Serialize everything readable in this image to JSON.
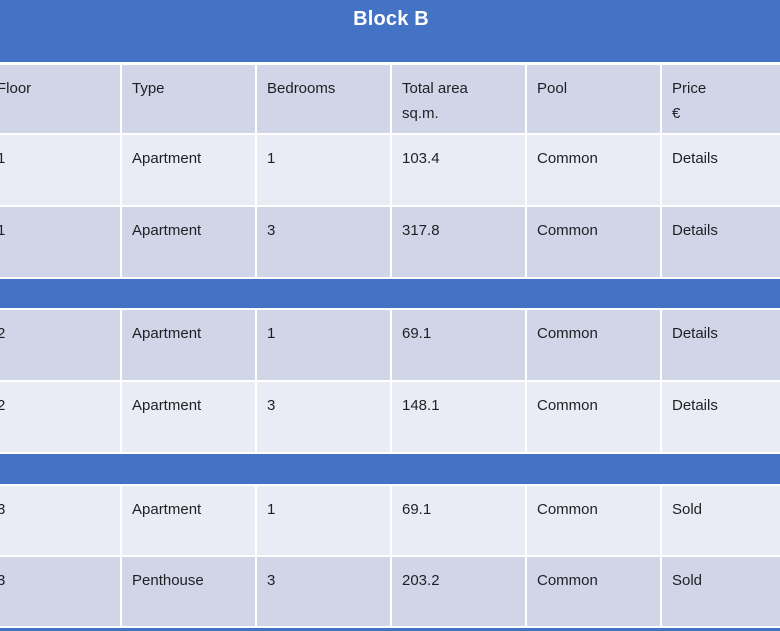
{
  "title": "Block B",
  "colors": {
    "header_blue": "#4472C4",
    "band_light": "#EAECF5",
    "band_dark": "#D0D5E8",
    "divider_white": "#FFFFFF",
    "text_dark": "#1F1F23",
    "title_white": "#FFFFFF"
  },
  "table": {
    "columns": [
      {
        "id": "floor",
        "label": "Floor"
      },
      {
        "id": "type",
        "label": "Type"
      },
      {
        "id": "bedrooms",
        "label": "Bedrooms"
      },
      {
        "id": "area",
        "label": "Total area",
        "sublabel": "sq.m."
      },
      {
        "id": "pool",
        "label": "Pool"
      },
      {
        "id": "price",
        "label": "Price",
        "sublabel": "€"
      }
    ],
    "groups": [
      {
        "floor": "1",
        "rows": [
          {
            "floor": "1",
            "type": "Apartment",
            "bedrooms": "1",
            "area": "103.4",
            "pool": "Common",
            "price": "Details"
          },
          {
            "floor": "1",
            "type": "Apartment",
            "bedrooms": "3",
            "area": "317.8",
            "pool": "Common",
            "price": "Details"
          }
        ]
      },
      {
        "floor": "2",
        "rows": [
          {
            "floor": "2",
            "type": "Apartment",
            "bedrooms": "1",
            "area": "69.1",
            "pool": "Common",
            "price": "Details"
          },
          {
            "floor": "2",
            "type": "Apartment",
            "bedrooms": "3",
            "area": "148.1",
            "pool": "Common",
            "price": "Details"
          }
        ]
      },
      {
        "floor": "3",
        "rows": [
          {
            "floor": "3",
            "type": "Apartment",
            "bedrooms": "1",
            "area": "69.1",
            "pool": "Common",
            "price": "Sold"
          },
          {
            "floor": "3",
            "type": "Penthouse",
            "bedrooms": "3",
            "area": "203.2",
            "pool": "Common",
            "price": "Sold"
          }
        ]
      }
    ]
  }
}
